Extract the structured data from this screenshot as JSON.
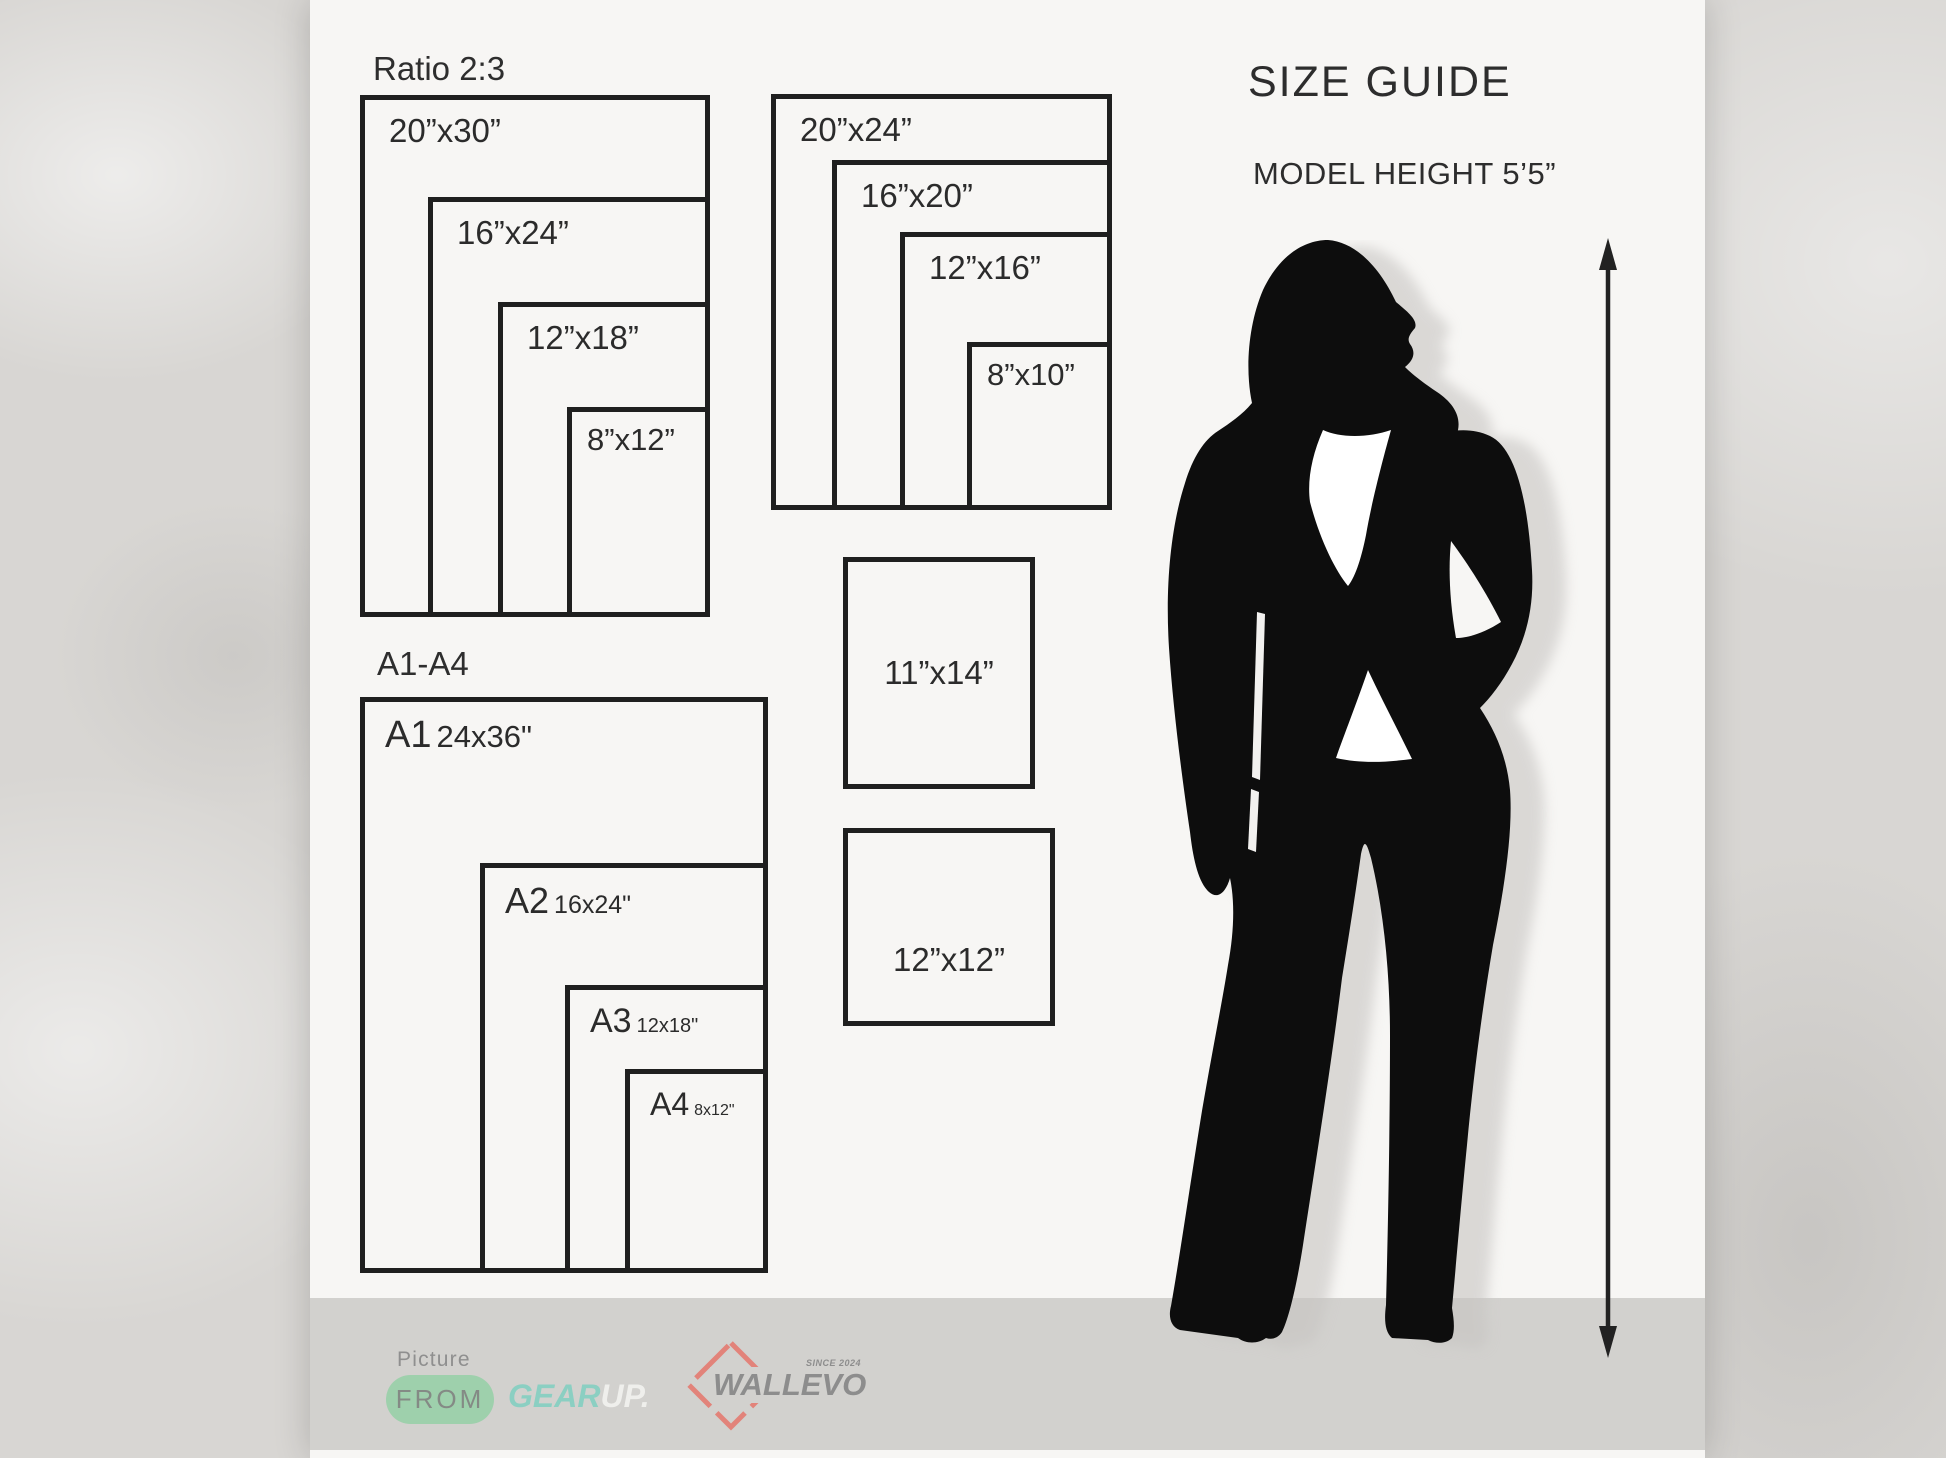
{
  "poster": {
    "heading": {
      "title": "SIZE GUIDE",
      "model_height": "MODEL HEIGHT 5’5”"
    },
    "ratio_group": {
      "title": "Ratio 2:3",
      "sizes": [
        "20”x30”",
        "16”x24”",
        "12”x18”",
        "8”x12”"
      ]
    },
    "standard_group": {
      "sizes": [
        "20”x24”",
        "16”x20”",
        "12”x16”",
        "8”x10”"
      ]
    },
    "a_series_group": {
      "title": "A1-A4",
      "items": [
        {
          "code": "A1",
          "dim": "24x36\""
        },
        {
          "code": "A2",
          "dim": "16x24\""
        },
        {
          "code": "A3",
          "dim": "12x18\""
        },
        {
          "code": "A4",
          "dim": "8x12\""
        }
      ]
    },
    "single_boxes": [
      {
        "label": "11”x14”"
      },
      {
        "label": "12”x12”"
      }
    ]
  },
  "footer": {
    "picture_label": "Picture",
    "from_label": "FROM",
    "gearup": {
      "gear": "GEAR",
      "up": "UP."
    },
    "wallevo": {
      "name": "WALLEVO",
      "since": "SINCE 2024"
    }
  },
  "colors": {
    "canvas_texture": "#d8d6d3",
    "poster_bg": "#f7f6f4",
    "footer_band": "#d2d1ce",
    "box_border": "#1f1f1f",
    "silhouette_black": "#0d0d0d",
    "shadow_gray": "#c7c5c2",
    "from_pill_green": "#9ed0ac",
    "gear_teal": "#8bcfc2",
    "up_white": "#efefec",
    "wallevo_gray": "#8d8d8d",
    "diamond_red": "#e2837a"
  }
}
